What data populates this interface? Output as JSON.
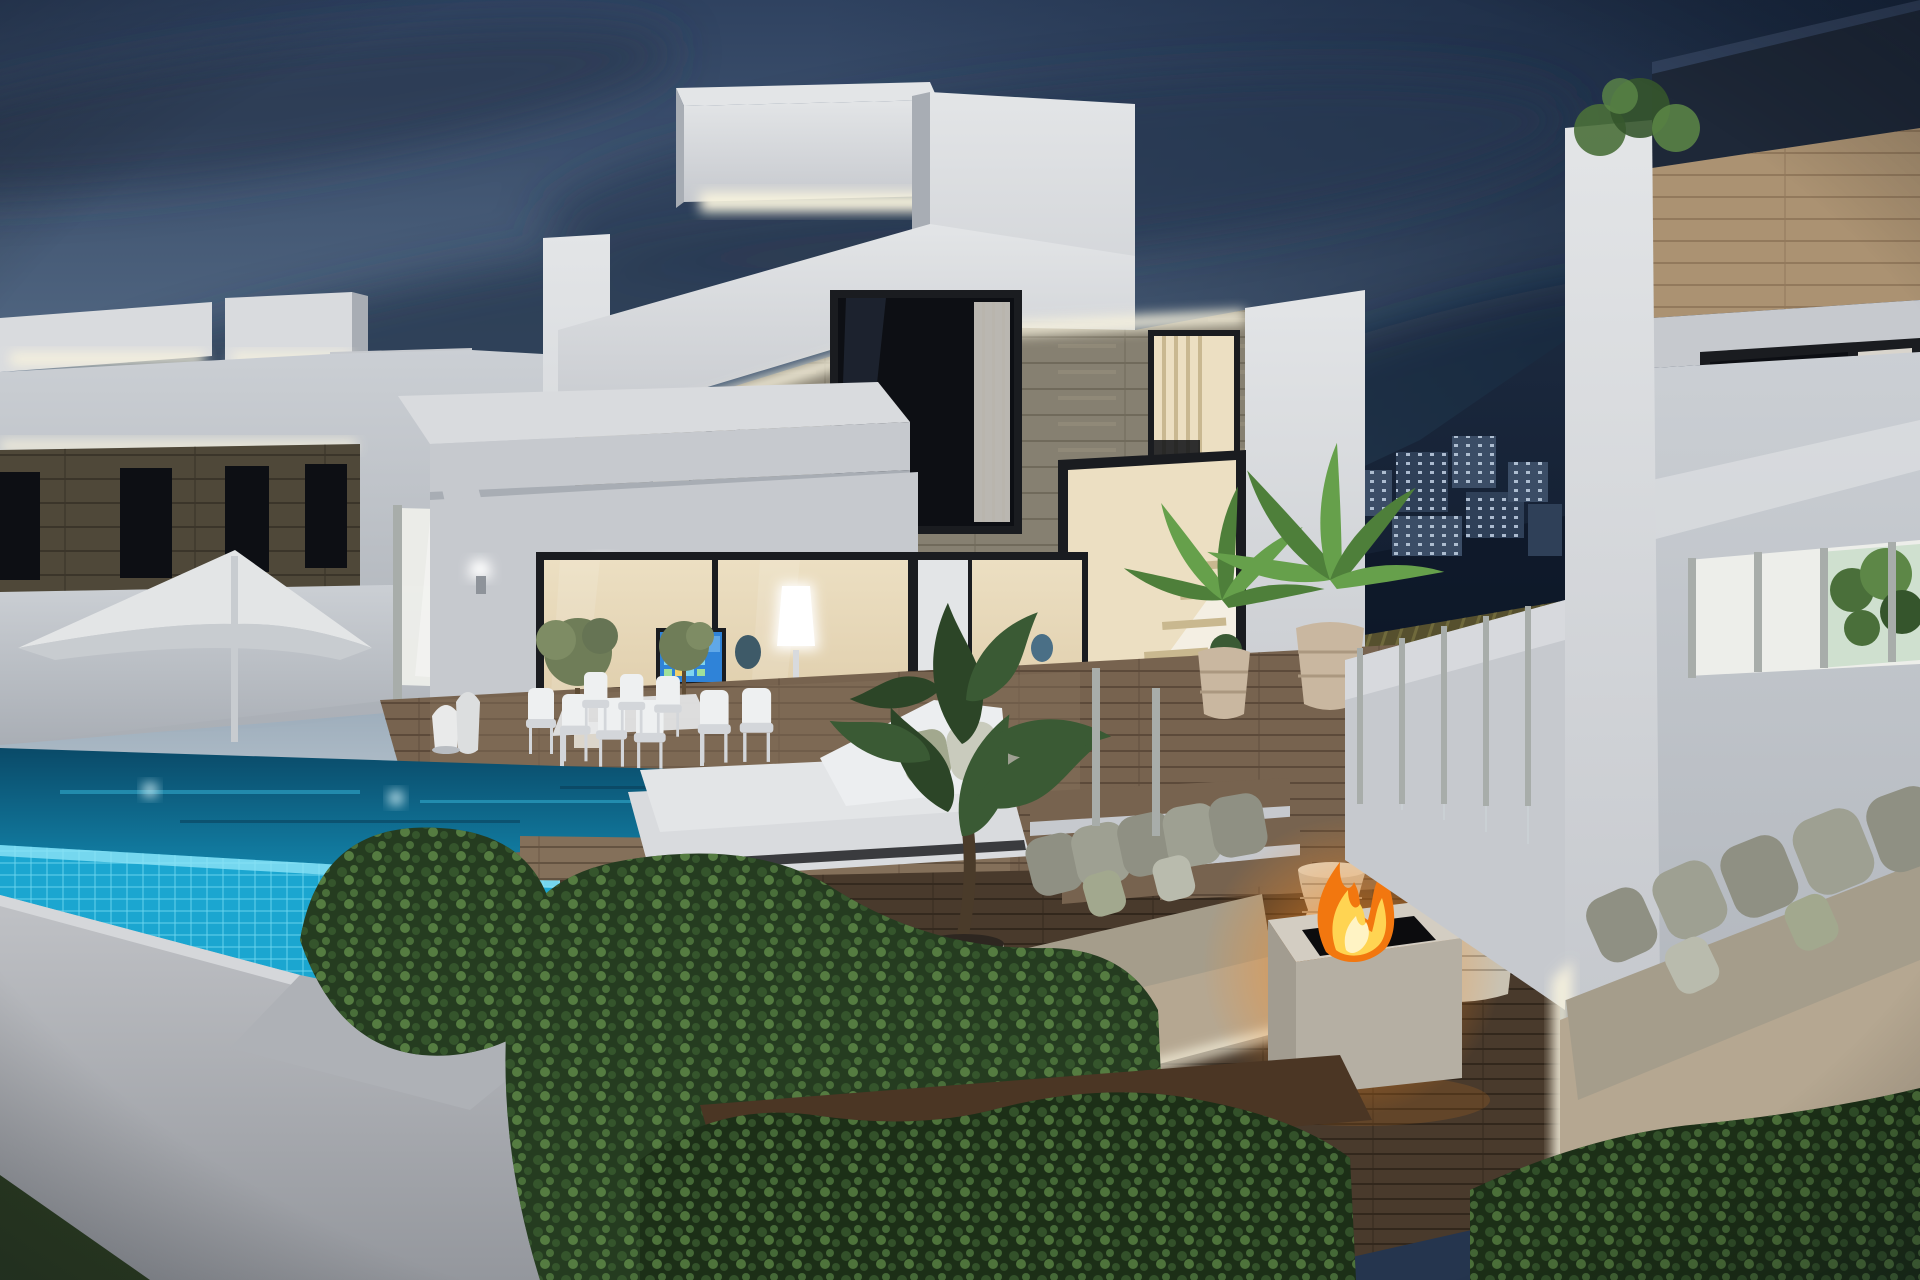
{
  "meta": {
    "title": "Modern luxury villa with infinity pool at dusk",
    "type": "3d-architectural-render",
    "time_of_day": "dusk",
    "visible_text": "none"
  },
  "palette": {
    "sky-top": "#2f4260",
    "sky-mid": "#5b718b",
    "sky-horizon": "#bac7d0",
    "sky-right": "#152339",
    "cloud-dark": "#26374f",
    "cloud-mid": "#31445e",
    "cloud-light": "#93a7b8",
    "mountain": "#1c2a40",
    "mountain-dark": "#0e1828",
    "bldg": "#3b4d66",
    "bldg2": "#2f4058",
    "bldg-window": "#b9c9dc",
    "bamboo": "#56502e",
    "bamboo-line": "#77713f",
    "white-lit": "#d9dbde",
    "white-bright": "#e3e5e7",
    "white-mid": "#c6c9ce",
    "white-shadow": "#a8adb4",
    "wall-left-top": "#cbcfd4",
    "wall-left-bottom": "#a9aeb5",
    "stone-light": "#868071",
    "stone-line": "#6e6759",
    "stone-hi": "#9b947f",
    "stone-dark": "#4f4839",
    "stone-dark-line": "#3b352a",
    "wood-band": "#ab9272",
    "wood-band-line": "#8d7458",
    "frame-dark": "#1a1c20",
    "glass-dark": "#0d0f14",
    "curtain": "#d9d5cd",
    "roof-dark": "#1e2838",
    "interior-warm": "#ecdfc2",
    "interior-warm2": "#d8c49f",
    "interior-cool": "#f4efe3",
    "led-warm": "#f8f3de",
    "sconce-white": "#ffffff",
    "tv-blue": "#2f83d8",
    "tv-tile": "#7fd4f0",
    "pool-deep": "#0a4a68",
    "pool-mid": "#1387ae",
    "pool-tile": "#1ba6d0",
    "pool-tile-line": "#6fd8f0",
    "pool-glint": "#37b7da",
    "deck-light": "#77634f",
    "deck-line": "#574636",
    "deck-dark": "#493a2c",
    "deck-dark-line": "#32271c",
    "deck-warm": "#84705a",
    "hedge-base": "#253c20",
    "hedge-dark-base": "#1c2f17",
    "leaf-1": "#35552c",
    "leaf-2": "#4a6f3a",
    "leaf-3": "#5d8747",
    "palm-1": "#4e7f3a",
    "palm-2": "#66a04b",
    "plant-dark": "#3a5a34",
    "plant-dark2": "#2c4527",
    "pot-beige": "#c9b7a0",
    "pot-beige-line": "#ab9880",
    "pot-white": "#dcd6cb",
    "sofa-base": "#b5a791",
    "cushion-1": "#8f9083",
    "cushion-2": "#9ea092",
    "cushion-sage": "#a2a88e",
    "cushion-seat": "#a59d8b",
    "fire-orange": "#f2770f",
    "fire-yellow": "#ffd452",
    "fire-deep": "#c44e08",
    "fire-glow": "#ff8c1e",
    "wicker": "#c9c2b2",
    "lantern-white": "#e9eaea",
    "umbrella-white": "#e3e5e6",
    "umbrella-shade": "#c8ccd0",
    "glass-frost": "#edeeea",
    "post-metal": "#a8adaa",
    "glass-tint": "#cfd8da",
    "wall-fore-top": "#c0c2c6",
    "wall-fore-bottom": "#94979d",
    "grass-dark": "#2c3d22",
    "soil": "#4b3624",
    "chair-white": "#eef0f1",
    "chair-shadow": "#d3d6da",
    "trunk": "#5f4c34",
    "olive-green": "#6f7d58"
  },
  "scene": {
    "objects": [
      "dusk-sky",
      "cloud-bank",
      "mountain-with-apartment-blocks",
      "cane-pergola-canopy",
      "left-villa",
      "main-villa",
      "right-villa",
      "rooftop-led-cove-lighting",
      "stone-clad-facade",
      "staircase-window",
      "sliding-glass-doors",
      "tv-screen",
      "floor-lamp",
      "wall-sconces",
      "white-parasol",
      "frosted-privacy-panels",
      "glass-balustrade",
      "outdoor-dining-set",
      "wicker-lanterns",
      "olive-trees",
      "infinity-pool",
      "pool-underwater-lights",
      "wood-deck",
      "white-daybed",
      "sunken-lounge",
      "outdoor-sofa-left",
      "outdoor-sofa-right",
      "fire-pit-table",
      "wicker-side-table",
      "coffee-table-with-citrus-tree",
      "alocasia-plant",
      "potted-palms",
      "hedges",
      "garden-wall",
      "lawn-corner"
    ]
  }
}
